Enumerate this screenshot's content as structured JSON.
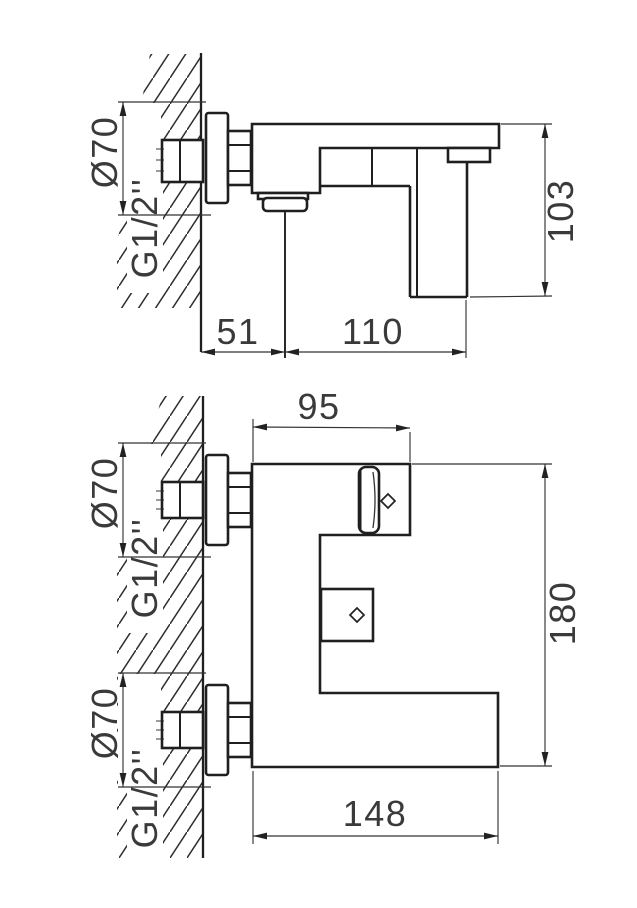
{
  "colors": {
    "line": "#1f1f1f",
    "dimension_line": "#333333",
    "text": "#3a3a3a",
    "background": "#ffffff"
  },
  "side_view": {
    "labels": {
      "escutcheon_diameter": "Ø70",
      "inlet_thread": "G1/2''",
      "wall_to_spout_center": "51",
      "spout_center_to_handle": "110",
      "overall_height": "103"
    }
  },
  "front_view": {
    "labels": {
      "body_projection": "95",
      "overall_height": "180",
      "overall_width": "148",
      "top_connection": {
        "escutcheon_diameter": "Ø70",
        "inlet_thread": "G1/2''"
      },
      "bottom_connection": {
        "escutcheon_diameter": "Ø70",
        "inlet_thread": "G1/2''"
      }
    }
  }
}
